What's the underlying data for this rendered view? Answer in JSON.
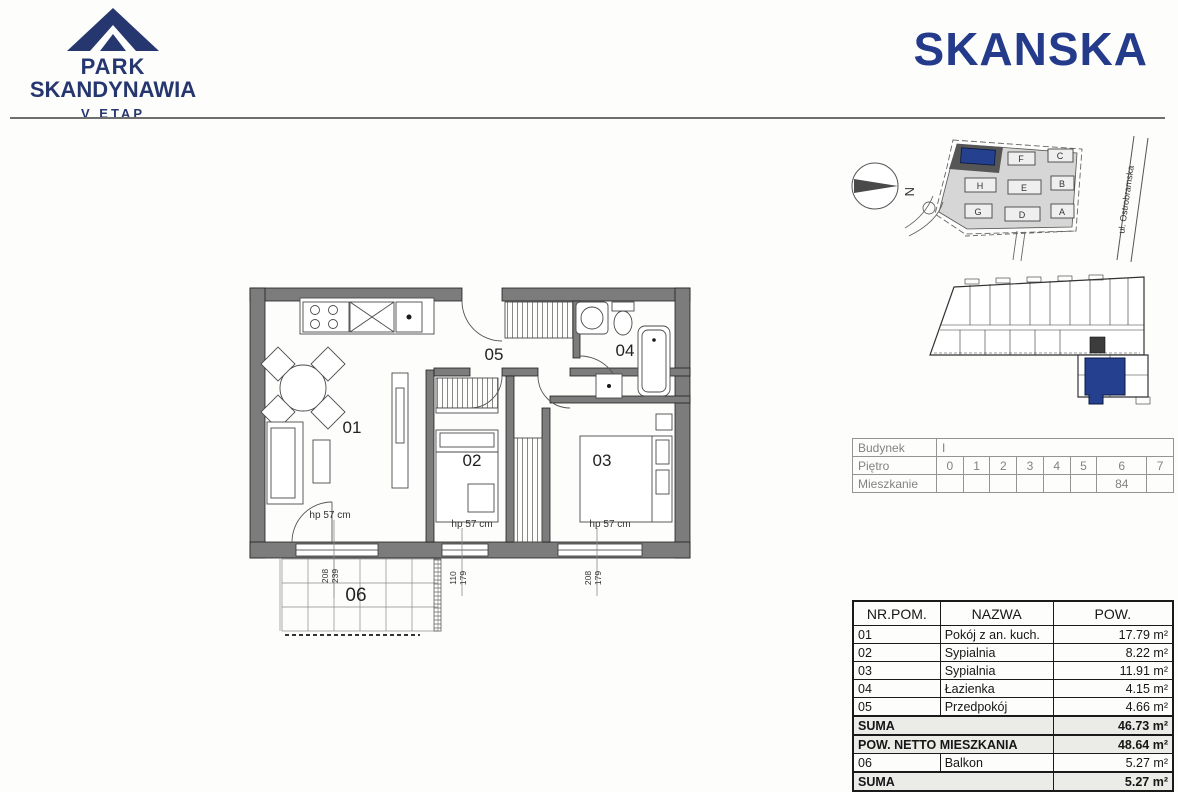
{
  "header": {
    "project_line1": "PARK",
    "project_line2": "SKANDYNAWIA",
    "stage": "V ETAP",
    "company": "SKANSKA"
  },
  "colors": {
    "brand_navy": "#26366f",
    "skanska_blue": "#243a8a",
    "highlight_unit": "#24408f",
    "wall_gray": "#7c7c7c",
    "site_gray": "#d6d6d6"
  },
  "site_plan": {
    "north_label": "N",
    "street": "ul. Ostrobramska",
    "highlighted_building": "I",
    "buildings": [
      "F",
      "C",
      "H",
      "E",
      "B",
      "G",
      "D",
      "A"
    ]
  },
  "floor_plan": {
    "room_labels": [
      "01",
      "02",
      "03",
      "04",
      "05",
      "06"
    ],
    "sill_label": "hp 57 cm",
    "dims": [
      [
        "208",
        "239"
      ],
      [
        "110",
        "179"
      ],
      [
        "208",
        "179"
      ]
    ]
  },
  "unit_info": {
    "building_label": "Budynek",
    "building_value": "I",
    "floor_label": "Piętro",
    "floors": [
      "0",
      "1",
      "2",
      "3",
      "4",
      "5",
      "6",
      "7"
    ],
    "apartment_label": "Mieszkanie",
    "apartment_number": "84"
  },
  "area_table": {
    "col_headers": [
      "NR.POM.",
      "NAZWA",
      "POW."
    ],
    "rows": [
      {
        "no": "01",
        "name": "Pokój z an. kuch.",
        "area": "17.79 m²"
      },
      {
        "no": "02",
        "name": "Sypialnia",
        "area": "8.22 m²"
      },
      {
        "no": "03",
        "name": "Sypialnia",
        "area": "11.91 m²"
      },
      {
        "no": "04",
        "name": "Łazienka",
        "area": "4.15 m²"
      },
      {
        "no": "05",
        "name": "Przedpokój",
        "area": "4.66 m²"
      }
    ],
    "suma_label": "SUMA",
    "suma_value": "46.73 m²",
    "netto_label": "POW. NETTO MIESZKANIA",
    "netto_value": "48.64 m²",
    "balcony_row": {
      "no": "06",
      "name": "Balkon",
      "area": "5.27 m²"
    },
    "suma2_label": "SUMA",
    "suma2_value": "5.27 m²"
  }
}
